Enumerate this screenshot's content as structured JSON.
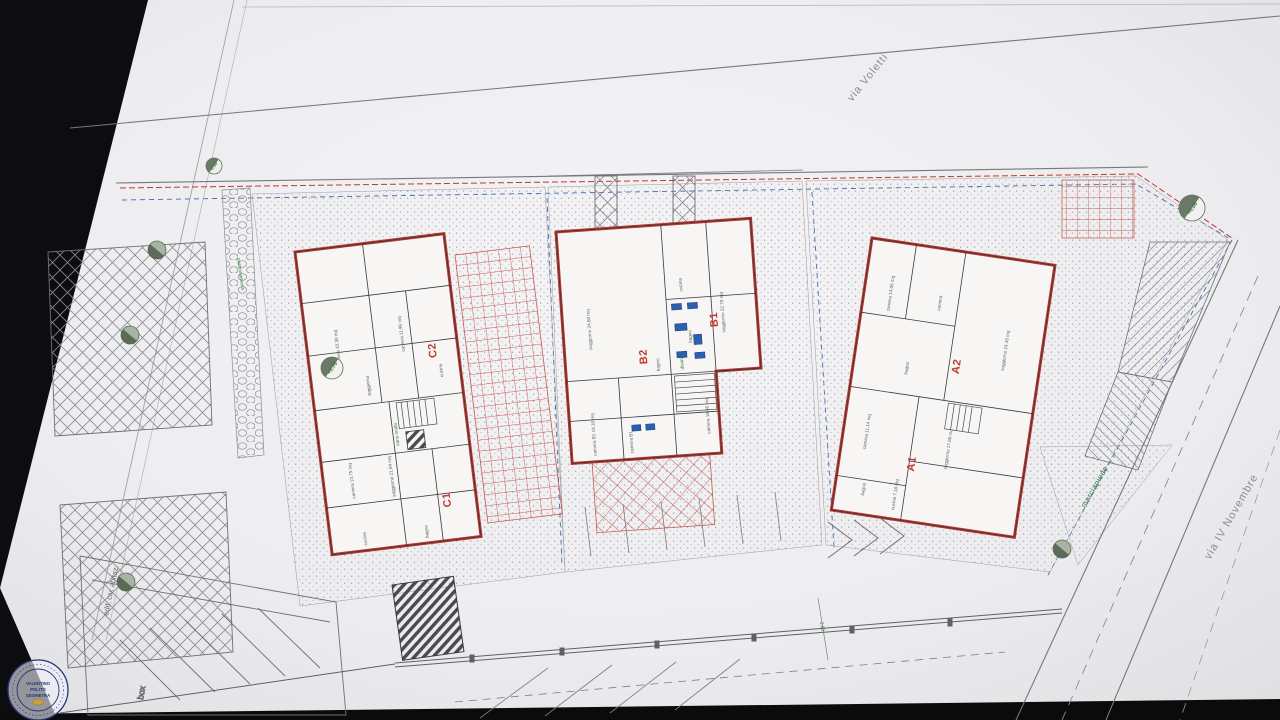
{
  "scene": {
    "description": "photographed architectural site plan on white paper over dark backdrop",
    "paper_color": "#eeedef",
    "backdrop_color": "#0d0d0f"
  },
  "streets": {
    "voletti": "via Voletti",
    "novembre": "via IV Novembre"
  },
  "annotations": {
    "marciapiede": "marciapiede",
    "camminamento": "camminamento",
    "box": "box",
    "edificio": "edif. civ. abitaz.",
    "dim": "3.80",
    "vano_scala": "vano scala",
    "disimp": "disimp."
  },
  "elevations": {
    "e070": "+0.70",
    "e000": "+0.00",
    "e010": "0.10"
  },
  "units": {
    "c2": "C2",
    "c1": "C1",
    "b2": "B2",
    "b1": "B1",
    "a2": "A2",
    "a1": "A1"
  },
  "rooms": {
    "c2": [
      "camera 15.30 mq",
      "camera 11.96 mq",
      "soggiorno",
      "cucina"
    ],
    "c1": [
      "soggiorno 21.54 mq",
      "camera 13.75 mq",
      "cucina",
      "bagno"
    ],
    "b2": [
      "soggiorno 24.60 mq",
      "camera B1 14.10 mq",
      "camera B1",
      "bagno"
    ],
    "b1": [
      "soggiorno 22.70 mq",
      "camera 18.40 mq",
      "cucina",
      "bagno"
    ],
    "a2": [
      "soggiorno 24.45 mq",
      "camera 14.05 mq",
      "camera",
      "bagno"
    ],
    "a1": [
      "soggiorno 17.60 mq",
      "camera 11.14 mq",
      "cucina 7.10 mq",
      "bagno"
    ]
  },
  "stamp": {
    "line1": "VALENTINO",
    "line2": "POLITO",
    "line3": "GEOMETRA"
  },
  "colors": {
    "wall_red": "#b8352c",
    "boundary_blue": "#3f6fae",
    "note_green": "#2f7a3d",
    "ink": "#55565c"
  }
}
